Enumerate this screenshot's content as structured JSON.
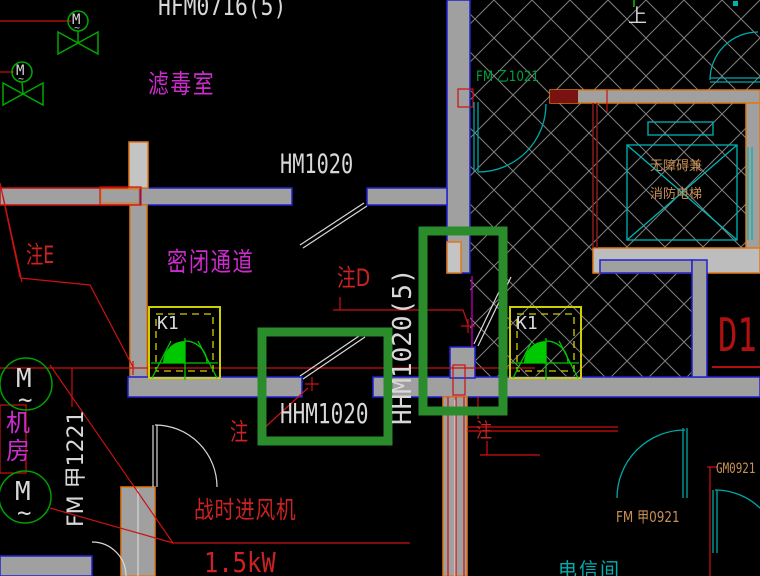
{
  "rooms": {
    "filter_room": "滤毒室",
    "sealed_passage": "密闭通道",
    "machine_room": "机房",
    "telecom_room": "电信间",
    "elevator_line1": "无障碍兼",
    "elevator_line2": "消防电梯"
  },
  "doors": {
    "hfm0716": "HFM0716(5)",
    "hm1020": "HM1020",
    "hhm1020": "HHM1020",
    "hhm1020_5": "HHM1020(5)",
    "fm_yi_1021": "FM 乙1021",
    "fm_jia_1221": "FM 甲1221",
    "fm_jia_0921": "FM 甲0921",
    "gm0921": "GM0921"
  },
  "equipment": {
    "k1_left": "K1",
    "k1_right": "K1",
    "fan_label": "战时进风机",
    "fan_power": "1.5kW",
    "motor_m": "M",
    "motor_tilde": "~",
    "valve_m": "M"
  },
  "annotations": {
    "note_e": "注E",
    "note_d": "注D",
    "note_bottom_left": "注",
    "note_bottom_right": "注",
    "d1": "D1",
    "up_marker": "上"
  },
  "colors": {
    "background": "#000000",
    "wall_fill": "#a0a0a0",
    "outline_blue": "#2020d0",
    "outline_orange": "#e07818",
    "outline_red": "#cc1111",
    "maroon": "#8b1a1a",
    "highlight_green": "#2a8c2a",
    "equipment_green": "#00c800",
    "valve_green": "#00a800",
    "text_white": "#d8d8d8",
    "text_magenta": "#cc2ccc",
    "text_red": "#cc2222",
    "text_tan": "#c89058",
    "text_cyan": "#00b0b0",
    "door_cyan": "#00a8a8",
    "k1_yellow": "#cfcf00",
    "hatch_gray": "#7f7f7f"
  }
}
